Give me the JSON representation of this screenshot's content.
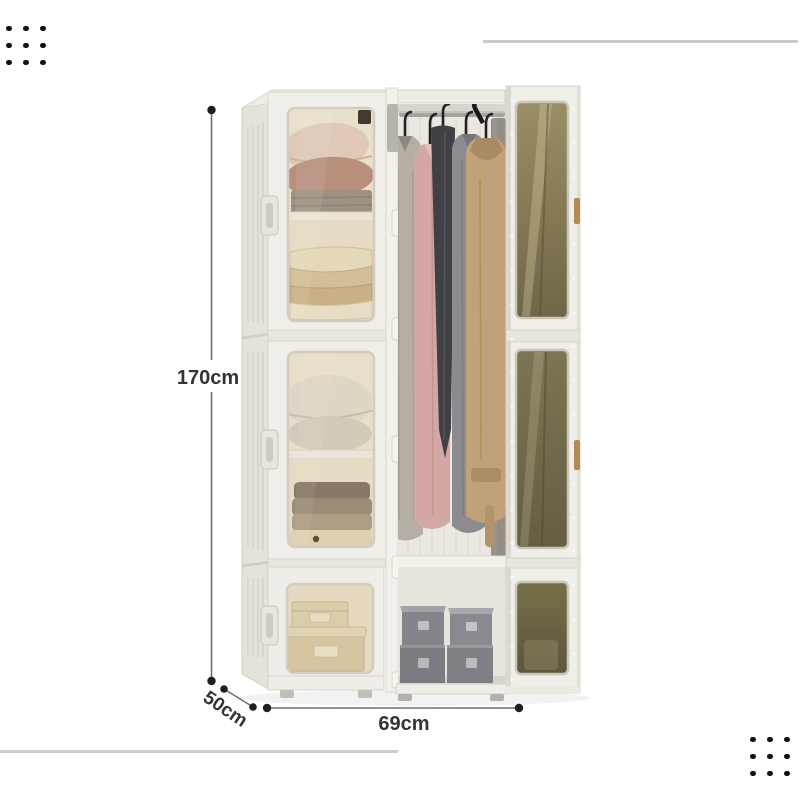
{
  "image": {
    "alt": "White modular folding wardrobe with amber transparent doors; right door open showing hanging coats, folded blankets, pillows and storage boxes"
  },
  "dimensions": {
    "height": "170cm",
    "depth": "50cm",
    "width": "69cm"
  },
  "colors": {
    "dimension_text": "#343434",
    "dimension_line": "#6f6f6f",
    "endpoint_dot": "#1f1f1f",
    "accent_line": "#c9c9c9",
    "decoration_dot": "#111111",
    "frame_white": "#f0eee9",
    "glass_amber": "#8d8158",
    "coat_pink": "#d3a7a3",
    "coat_tan": "#c1a17a",
    "storage_box_grey": "#85848b",
    "storage_box_cream": "#e2d7ba"
  }
}
